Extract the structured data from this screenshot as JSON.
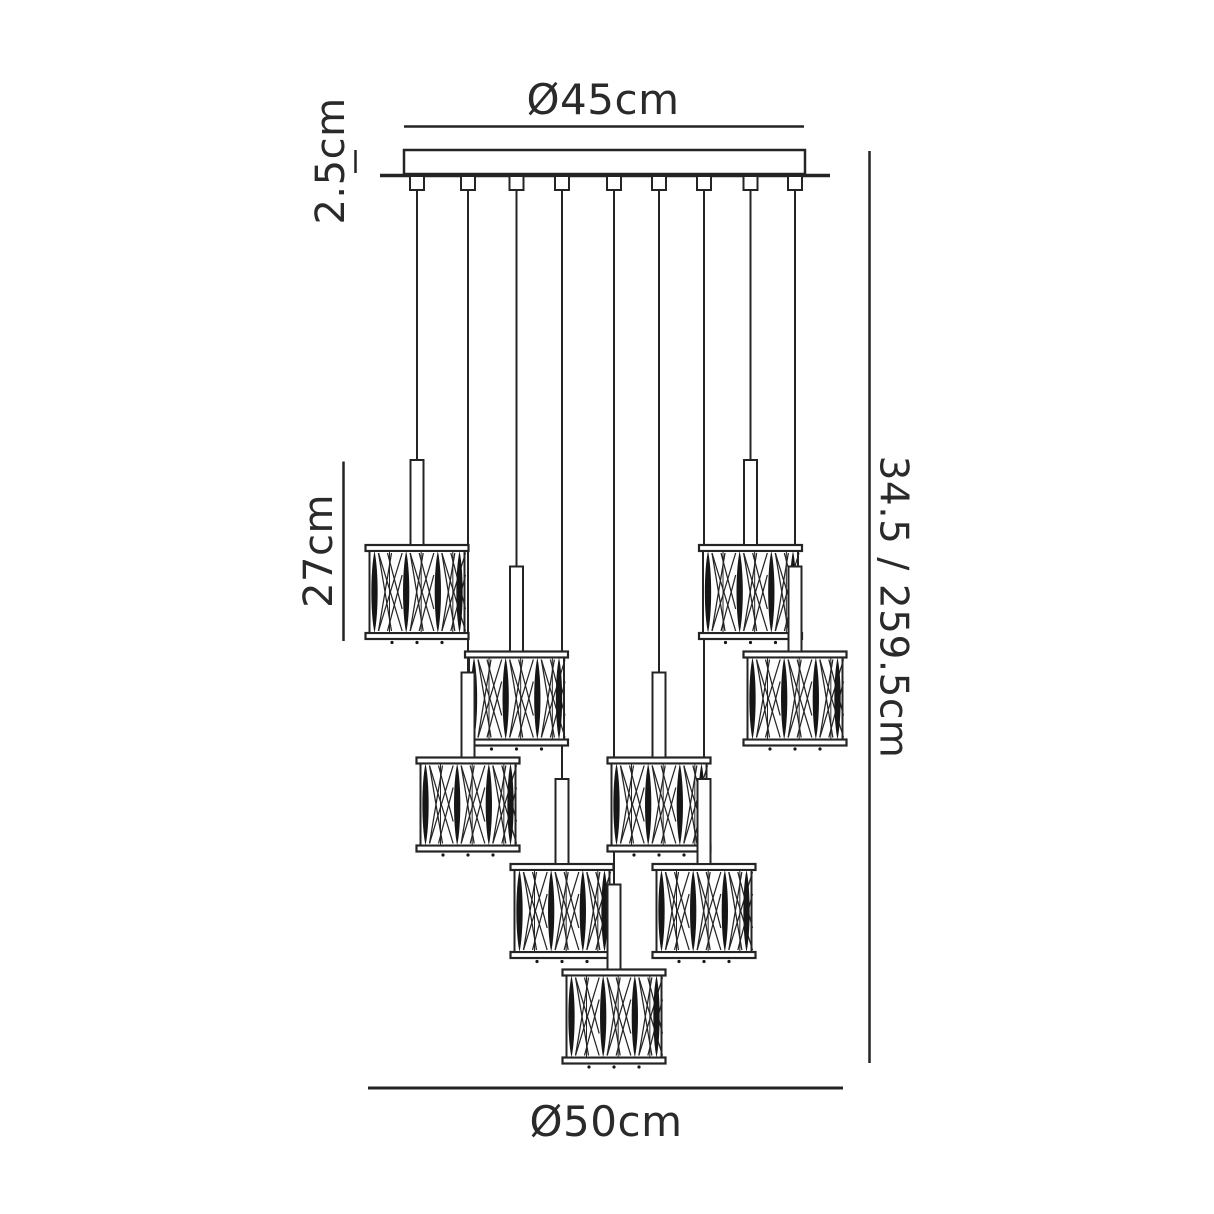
{
  "diagram": {
    "type": "technical-dimension-drawing",
    "subject": "nine-light multi-drop pendant chandelier",
    "background_color": "#ffffff",
    "line_color": "#242424",
    "labels": {
      "top_diameter": "Ø45cm",
      "canopy_height": "2.5cm",
      "pendant_height": "27cm",
      "overall_drop": "34.5 / 259.5cm",
      "bottom_spread": "Ø50cm"
    },
    "geometry": {
      "canopy": {
        "x1": 404,
        "x2": 805,
        "y1": 150,
        "y2": 174
      },
      "ceiling_plate_line": {
        "x1": 380,
        "x2": 830,
        "y": 175.5,
        "stroke": 3.5
      },
      "dim_top_line": {
        "x1": 404,
        "x2": 804,
        "y": 126.5
      },
      "dim_canopy_tick": {
        "x": 355.5,
        "y1": 150,
        "y2": 173
      },
      "dim_pendant_line": {
        "x": 343.5,
        "y1": 461.5,
        "y2": 641
      },
      "dim_right_line": {
        "x": 869.5,
        "y1": 151,
        "y2": 1063
      },
      "dim_bottom_line": {
        "x1": 368,
        "x2": 843,
        "y": 1088
      },
      "connector": {
        "w": 14,
        "h": 14,
        "y": 176
      },
      "cord_top_y": 190,
      "stem": {
        "w": 13,
        "h": 85
      },
      "drum": {
        "rim_w": 103,
        "rim_h": 6,
        "body_w": 95,
        "body_h": 82,
        "panels": 3
      },
      "level_tops": [
        545,
        651.5,
        757.5,
        864,
        969.5
      ],
      "pendants": [
        {
          "cord_x": 417,
          "level": 0
        },
        {
          "cord_x": 468,
          "level": 2
        },
        {
          "cord_x": 516.5,
          "level": 1
        },
        {
          "cord_x": 562,
          "level": 3
        },
        {
          "cord_x": 614,
          "level": 4
        },
        {
          "cord_x": 659,
          "level": 2
        },
        {
          "cord_x": 704,
          "level": 3
        },
        {
          "cord_x": 750.5,
          "level": 0
        },
        {
          "cord_x": 795,
          "level": 1
        }
      ]
    }
  }
}
